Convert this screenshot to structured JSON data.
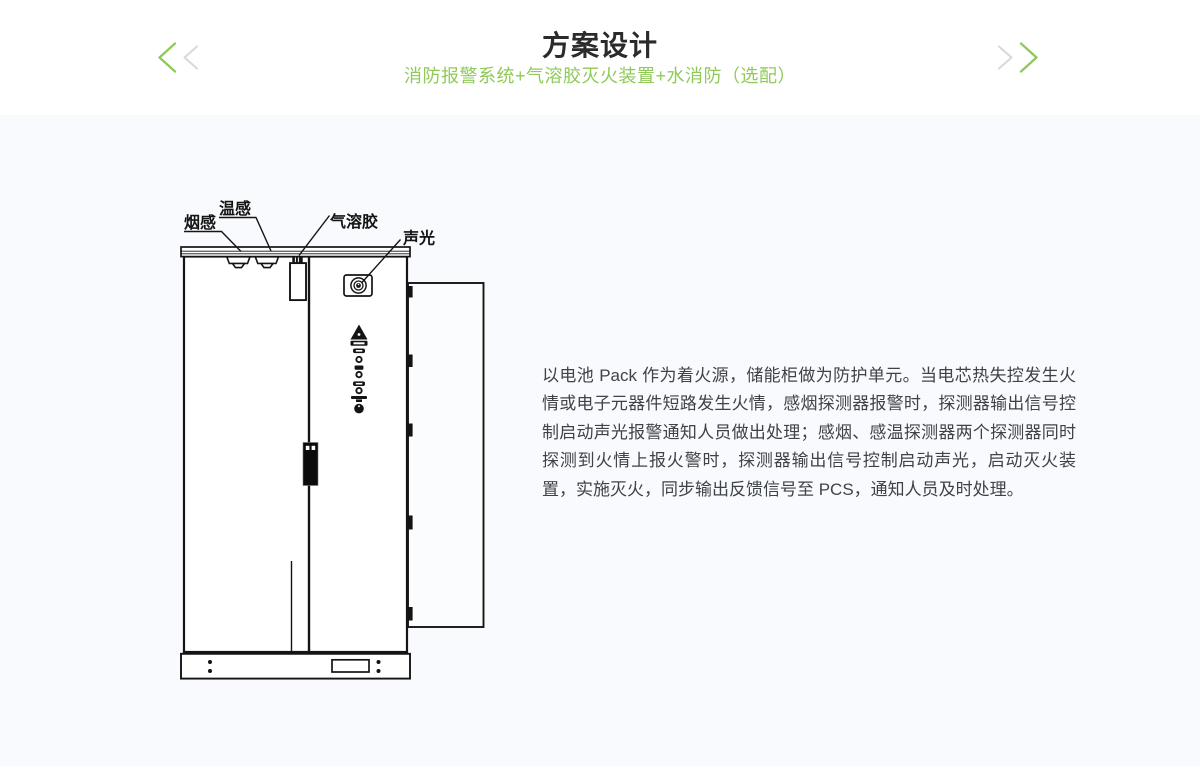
{
  "header": {
    "title": "方案设计",
    "subtitle": "消防报警系统+气溶胶灭火装置+水消防（选配）"
  },
  "carousel": {
    "prev_icon": "chevron-left",
    "next_icon": "chevron-right"
  },
  "diagram": {
    "labels": {
      "smoke": "烟感",
      "temp": "温感",
      "aerosol": "气溶胶",
      "sound_light": "声光"
    }
  },
  "description": {
    "text": "以电池 Pack 作为着火源，储能柜做为防护单元。当电芯热失控发生火情或电子元器件短路发生火情，感烟探测器报警时，探测器输出信号控制启动声光报警通知人员做出处理；感烟、感温探测器两个探测器同时探测到火情上报火警时，探测器输出信号控制启动声光，启动灭火装置，实施灭火，同步输出反馈信号至 PCS，通知人员及时处理。"
  },
  "colors": {
    "accent_green": "#8fca58",
    "chevron_gray": "#d9d9d9",
    "title_text": "#2b2b2b",
    "body_text": "#3e4347",
    "content_bg": "#f9fafd",
    "diagram_line": "#141414"
  }
}
